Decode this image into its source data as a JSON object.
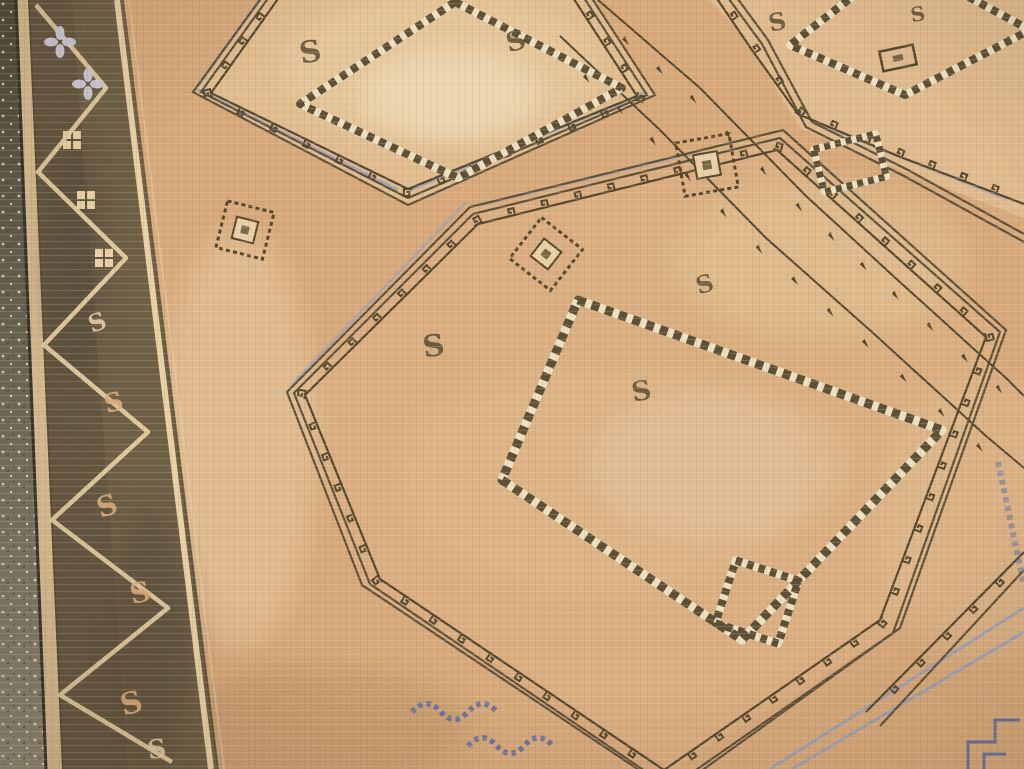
{
  "scene": {
    "subject": "Close-up photograph of a vintage hand-knotted tribal rug (Oushak style) lying on a speckled stone floor, shot at an oblique angle so the weave recedes toward the top",
    "visible_text": "none",
    "lighting": "soft even daylight, gentle vignette",
    "condition": "evenly worn low pile with faded, abrashed motifs"
  },
  "palette": {
    "field": "#d7a97b",
    "field_pale": "#e9cfa4",
    "wear_light": "#f1e3c6",
    "earth_shadow": "#8a6a46",
    "motif_brown": "#55482e",
    "outline_brown": "#60523a",
    "border_band": "#6d5f46",
    "border_band_dark": "#4e4635",
    "cream": "#e8d0a4",
    "peach": "#d9a977",
    "blossom": "#cdc9d8",
    "lavender": "#98a0bc",
    "indigo": "#5e6da0",
    "chain_cream": "#ece0c0",
    "selvage": "#d8bc92",
    "edge_line": "#38322a",
    "floor_dark": "#4e4a3b",
    "floor_mid": "#6a6553",
    "floor_light": "#8d8873",
    "speckle_light": "#e8e4d4",
    "speckle_dark": "#3a372c",
    "shadow_tint": "#3f2a16"
  },
  "motifs": {
    "s_glyph": "S",
    "medallions": [
      "top-left octagonal gul with latch-hook border and chained inner diamond",
      "large central octagonal gul with latch-hook border and chained inner diamond",
      "top-right partial gul with chained diamond and small rectangle",
      "bottom-right partial gul edge with lavender guard lines and indigo key fragment"
    ],
    "border": "dark olive band with cream serpentine wave, S motifs, cross blossoms and quad-dot flowers",
    "accents": [
      "diagonal vine branches with pennant hooks between medallions",
      "scattered S motifs in the field",
      "indigo chain fragments along the bottom edge",
      "small hooked squares and chained diamonds floating in the field"
    ]
  }
}
